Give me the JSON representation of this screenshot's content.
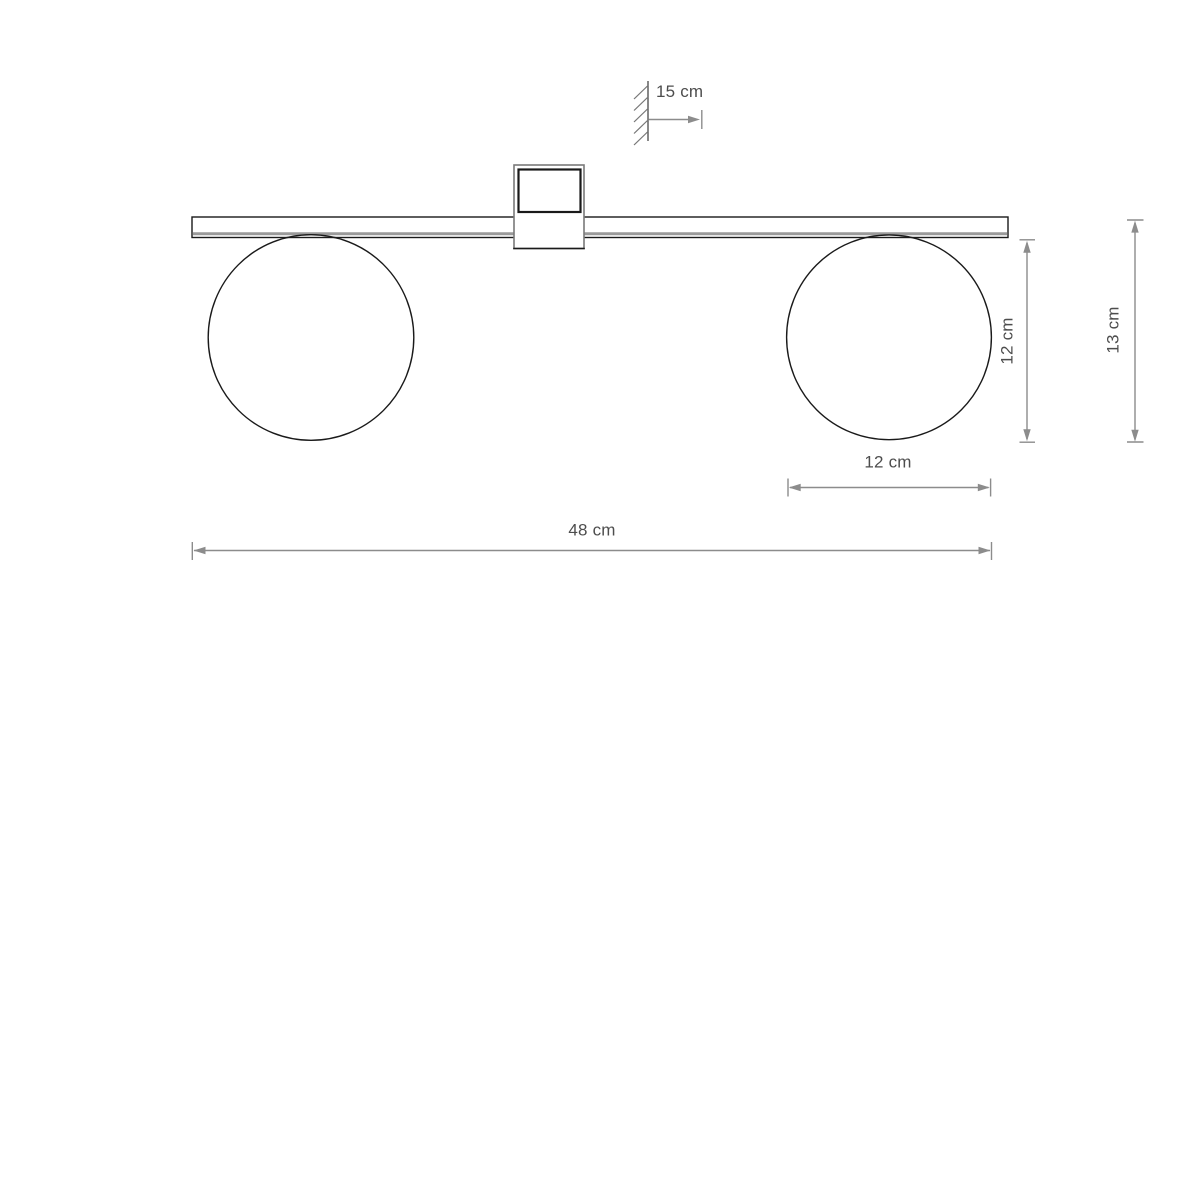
{
  "diagram": {
    "kind": "product-dimension-drawing",
    "labels": {
      "wall_offset": "15 cm",
      "total_width": "48 cm",
      "sphere_width": "12 cm",
      "sphere_height": "12 cm",
      "total_height": "13 cm"
    },
    "values_cm": {
      "wall_offset": 15,
      "total_width": 48,
      "sphere_width": 12,
      "sphere_height": 12,
      "total_height": 13
    },
    "colors": {
      "drawing_line": "#1a1a1a",
      "mount_outer_line": "#7a7a7a",
      "bar_accent_line": "#9a9a9a",
      "dimension_line": "#8c8c8c",
      "wall_symbol_line": "#555555",
      "label_text": "#4d4d4d",
      "background": "#ffffff"
    }
  }
}
